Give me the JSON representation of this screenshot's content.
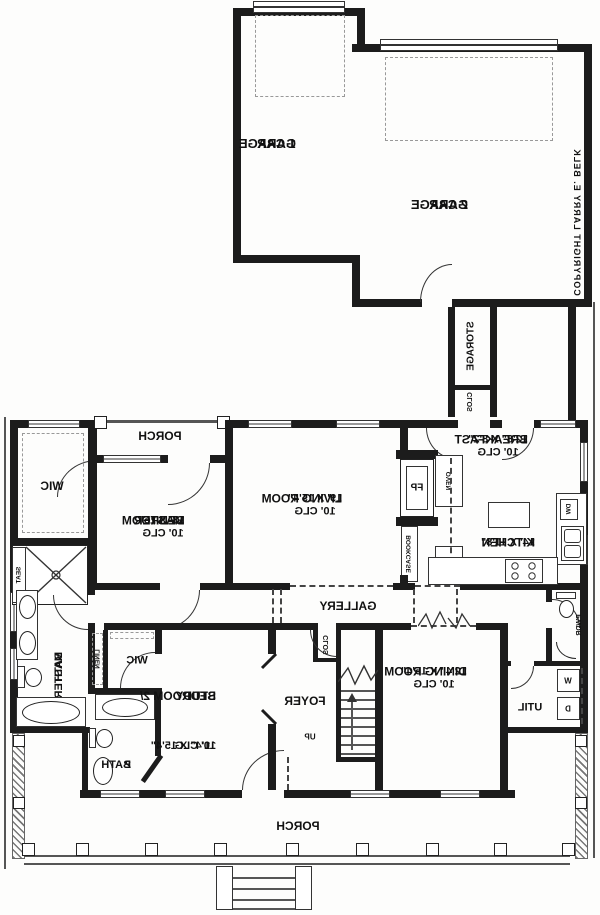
{
  "colors": {
    "wall": "#1c1c1c",
    "ink": "#111111",
    "background": "#fdfdfc"
  },
  "rooms": {
    "garage1": {
      "l1": "1 CAR",
      "l2": "GARAGE"
    },
    "garage2": {
      "l1": "2 CAR",
      "l2": "GARAGE"
    },
    "storage": {
      "name": "STORAGE"
    },
    "clos_garage": {
      "name": "CLOS"
    },
    "breakfast": {
      "name": "BREAKFAST",
      "dim": "12'8\" X 8'2\"",
      "clg": "10' CLG"
    },
    "porch_top": {
      "name": "PORCH"
    },
    "living": {
      "name": "LIVING ROOM",
      "dim": "19' X 15'4\"",
      "clg": "10' CLG"
    },
    "kitchen": {
      "name": "KITCHEN",
      "dim": "14' X 11'8\""
    },
    "wic_master": {
      "name": "WIC"
    },
    "master": {
      "l1": "MASTER",
      "l2": "BEDROOM",
      "dim": "13' X 15'",
      "clg": "10' CLG"
    },
    "master_bath": {
      "l1": "MASTER",
      "l2": "BATH"
    },
    "linen": {
      "name": "LINEN"
    },
    "seat": {
      "name": "SEAT"
    },
    "wic2": {
      "name": "WIC"
    },
    "clos_foyer": {
      "name": "CLOS"
    },
    "foyer": {
      "name": "FOYER"
    },
    "up": {
      "name": "UP"
    },
    "bedroom2": {
      "l1": "BEDROOM 2/",
      "l2": "STUDY",
      "dim": "11'4\" X 15'4\"",
      "clg": "10' CLG"
    },
    "bath2": {
      "l1": "BATH",
      "l2": "2"
    },
    "dining": {
      "name": "DINING ROOM",
      "dim": "12'4\" X 15'4\"",
      "clg": "10' CLG"
    },
    "gallery": {
      "name": "GALLERY"
    },
    "util": {
      "name": "UTIL"
    },
    "pwdr": {
      "name": "PWDR"
    },
    "porch_bottom": {
      "name": "PORCH"
    }
  },
  "fixtures": {
    "fp": "FP",
    "bookcase": "BOOKCASE",
    "oven": "OVEN",
    "ref": "REF",
    "dw": "DW",
    "washer": "W",
    "dryer": "D"
  },
  "annotations": {
    "copyright": "COPYRIGHT LARRY E. BELK"
  }
}
